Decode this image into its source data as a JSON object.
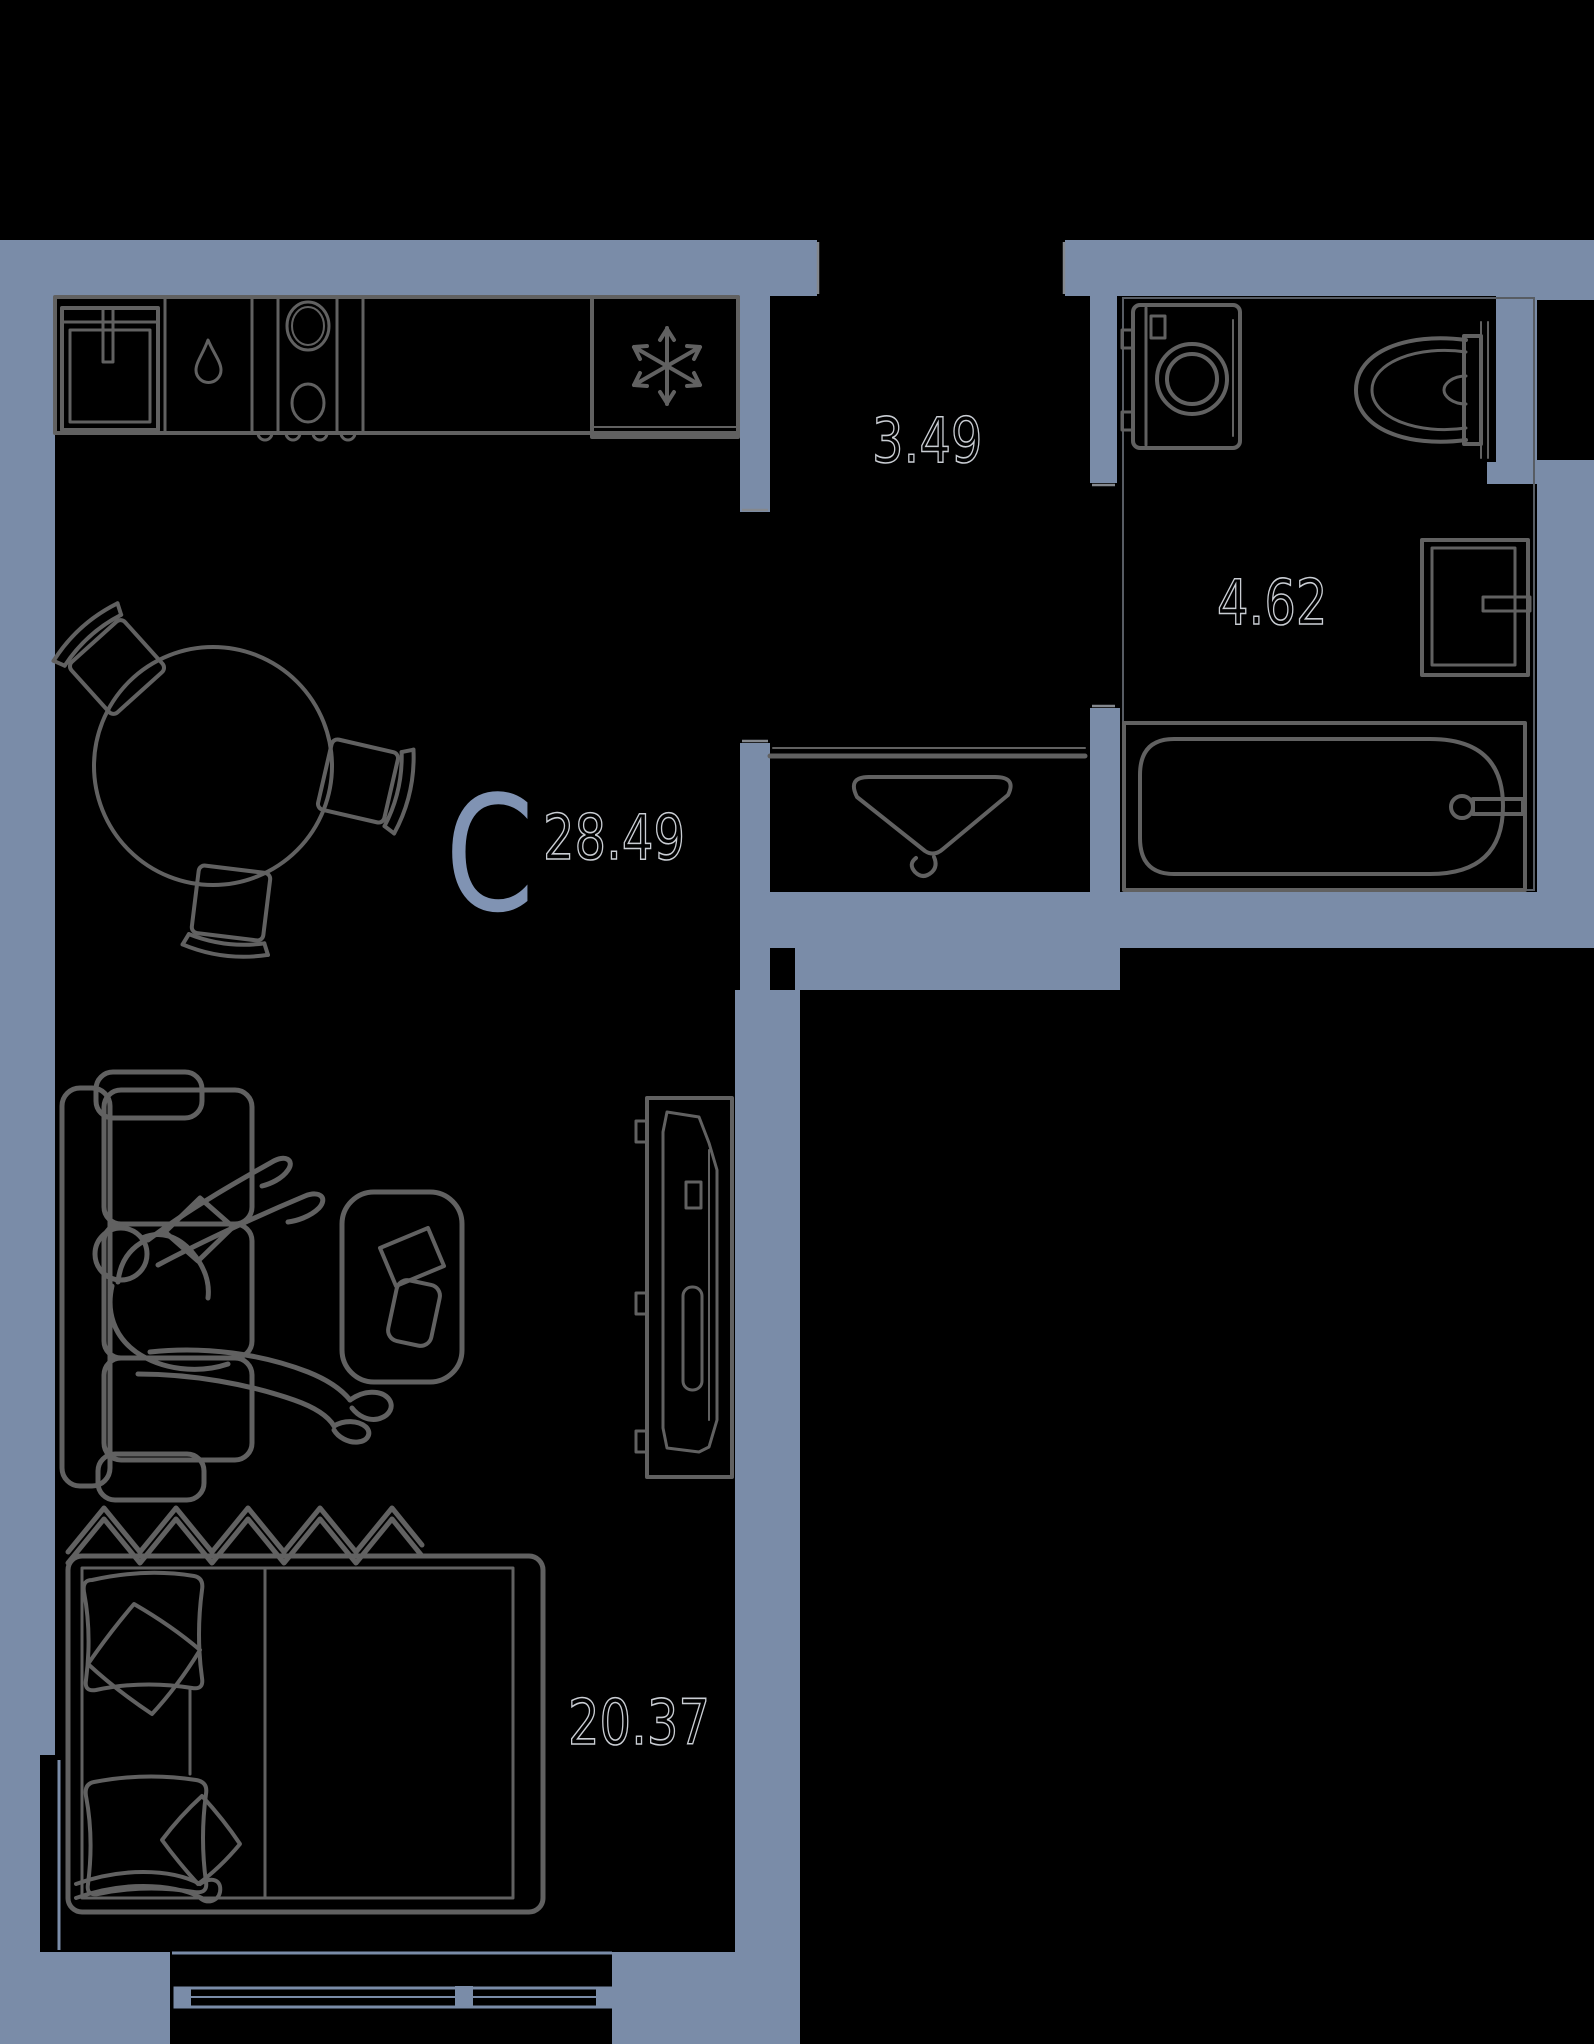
{
  "floor_plan": {
    "unit": {
      "type_letter": "С",
      "total_area": "28.49"
    },
    "rooms": [
      {
        "id": "hallway",
        "area": "3.49"
      },
      {
        "id": "bathroom",
        "area": "4.62"
      },
      {
        "id": "living_room",
        "area": "20.37"
      }
    ],
    "colors": {
      "background": "#000000",
      "wall": "#7a8ca8",
      "line": "#616161",
      "line_dark": "#575c63",
      "label_outline": "#c9cdd3",
      "type_letter": "#8093b3"
    },
    "icons": {
      "refrigerator": "snowflake-icon",
      "dishwasher": "water-drop-icon",
      "wardrobe": "hanger-icon"
    }
  }
}
